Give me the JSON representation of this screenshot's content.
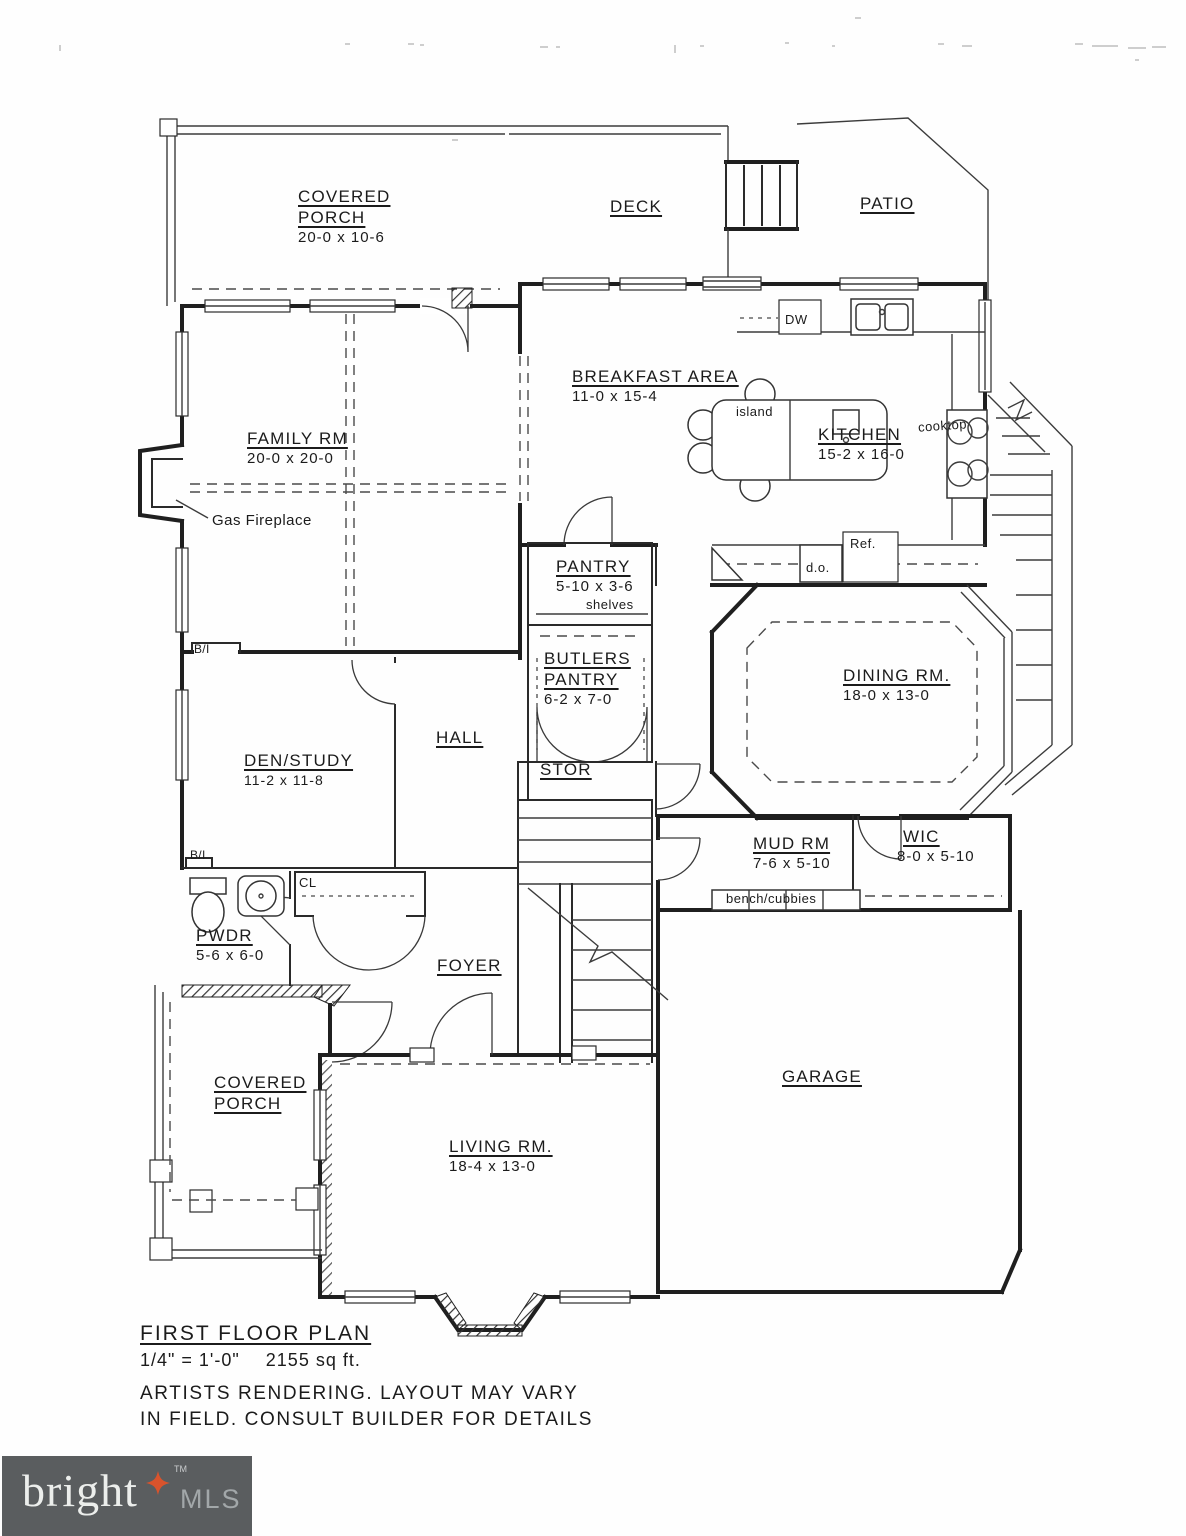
{
  "plan": {
    "rooms": {
      "covered_porch_top": {
        "name": "COVERED PORCH",
        "dims": "20-0 x 10-6"
      },
      "deck": {
        "name": "DECK"
      },
      "patio": {
        "name": "PATIO"
      },
      "breakfast": {
        "name": "BREAKFAST AREA",
        "dims": "11-0 x 15-4"
      },
      "kitchen": {
        "name": "KITCHEN",
        "dims": "15-2 x 16-0"
      },
      "family": {
        "name": "FAMILY RM",
        "dims": "20-0 x 20-0"
      },
      "pantry": {
        "name": "PANTRY",
        "dims": "5-10 x 3-6"
      },
      "butlers": {
        "name": "BUTLERS PANTRY",
        "dims": "6-2 x 7-0"
      },
      "dining": {
        "name": "DINING RM.",
        "dims": "18-0 x 13-0"
      },
      "den": {
        "name": "DEN/STUDY",
        "dims": "11-2 x 11-8"
      },
      "hall": {
        "name": "HALL"
      },
      "stor": {
        "name": "STOR"
      },
      "mud": {
        "name": "MUD RM",
        "dims": "7-6 x 5-10"
      },
      "wic": {
        "name": "WIC",
        "dims": "8-0 x 5-10"
      },
      "pwdr": {
        "name": "PWDR",
        "dims": "5-6 x 6-0"
      },
      "foyer": {
        "name": "FOYER"
      },
      "covered_porch_bottom": {
        "name": "COVERED PORCH"
      },
      "living": {
        "name": "LIVING RM.",
        "dims": "18-4 x 13-0"
      },
      "garage": {
        "name": "GARAGE"
      }
    },
    "annotations": {
      "gas_fireplace": "Gas Fireplace",
      "island": "island",
      "cooktop": "cooktop",
      "dw": "DW",
      "ref": "Ref.",
      "do": "d.o.",
      "shelves": "shelves",
      "bench_cubbies": "bench/cubbies",
      "bi_1": "B/I",
      "bi_2": "B/I",
      "cl": "CL"
    },
    "footer": {
      "title": "FIRST FLOOR PLAN",
      "scale": "1/4\" = 1'-0\"",
      "area": "2155 sq ft.",
      "disclaimer1": "ARTISTS RENDERING. LAYOUT MAY VARY",
      "disclaimer2": "IN FIELD. CONSULT BUILDER FOR DETAILS"
    }
  },
  "logo": {
    "brand": "bright",
    "tm": "TM",
    "suffix": "MLS",
    "colors": {
      "background": "#5a5d5f",
      "star": "#d9532c",
      "brand_text": "#eceeec",
      "suffix_text": "#a2a7a9"
    }
  },
  "drawing": {
    "line_color": "#1f1f1f",
    "paper_color": "#fefefe"
  }
}
